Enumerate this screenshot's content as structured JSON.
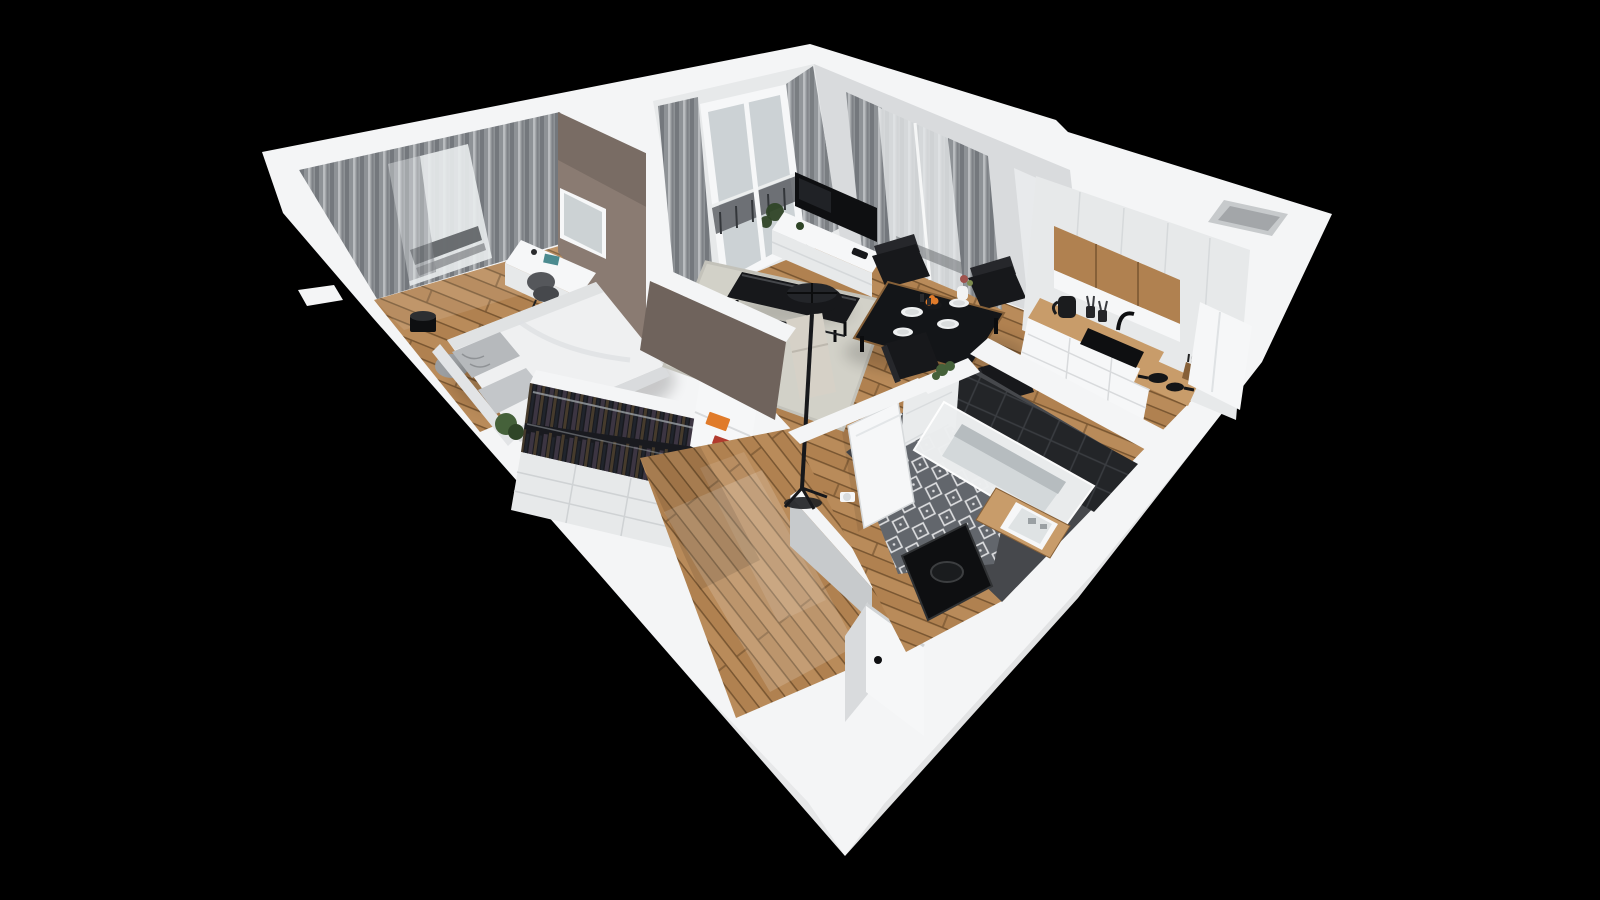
{
  "scene": {
    "type": "3d-floorplan-cutaway-render",
    "rooms": [
      {
        "name": "bedroom",
        "furniture": [
          "curtained-window",
          "accent-wall",
          "mirror",
          "desk",
          "desk-chair",
          "double-bed",
          "pillows",
          "floor-pouf",
          "plant-pot",
          "bedside-plant"
        ]
      },
      {
        "name": "wardrobe-nook",
        "furniture": [
          "open-wardrobe-clothes",
          "drawer-cabinets",
          "book-shelf"
        ]
      },
      {
        "name": "living-room",
        "furniture": [
          "balcony-door",
          "curtains",
          "tv",
          "media-console",
          "area-rug",
          "coffee-table",
          "sofa",
          "tripod-floor-lamp",
          "dining-table",
          "dining-chairs",
          "potted-plant"
        ]
      },
      {
        "name": "kitchen",
        "furniture": [
          "tall-cabinets",
          "wood-upper-cabinets",
          "countertop",
          "sink",
          "faucet",
          "kettle",
          "utensil-cups",
          "cooktop-pots",
          "knife-block"
        ]
      },
      {
        "name": "bathroom",
        "furniture": [
          "bathtub",
          "dark-tile-wall",
          "white-tile-wall",
          "patterned-tile-floor",
          "wood-vanity",
          "sink-basin",
          "washing-machine",
          "bathroom-door",
          "toilet-paper-holder",
          "shelf-plant"
        ]
      },
      {
        "name": "hallway",
        "furniture": [
          "entry-door",
          "sunlight-streak"
        ]
      }
    ]
  },
  "colors": {
    "bg": "#000000",
    "wall-top": "#f4f5f6",
    "wall-light": "#e7e9ea",
    "wall-mid": "#d9dbdd",
    "wall-shade": "#c7cacc",
    "wall-dark": "#a8abae",
    "taupe": "#8a7b72",
    "taupe-dark": "#6f635c",
    "wood": "#b08150",
    "wood-light": "#c89c6a",
    "wood-dark": "#866038",
    "wood-seam": "#7a5732",
    "rug": "#d2d1c8",
    "curtain": "#8e9296",
    "curtain-dark": "#74787d",
    "curtain-light": "#b9bcbf",
    "glass": "#ccd2d5",
    "window-bright": "#e9eced",
    "railing": "#55585c",
    "black-furniture": "#17181b",
    "near-black": "#0e0f11",
    "charcoal": "#26272b",
    "clothes-a": "#3c3542",
    "clothes-b": "#463b2c",
    "clothes-c": "#20242c",
    "tile-dark": "#232528",
    "tile-grid": "#3a3d41",
    "bath-tile-bg": "#62666c",
    "bath-tile-fg": "#dcdddf",
    "tub": "#edeff0",
    "tub-inner": "#d3d8da",
    "green": "#45613a",
    "green-dark": "#2f4527",
    "orange": "#e07b2a",
    "red": "#b23b2e",
    "white": "#f6f7f8",
    "gray-pouf": "#9b9ea1"
  }
}
